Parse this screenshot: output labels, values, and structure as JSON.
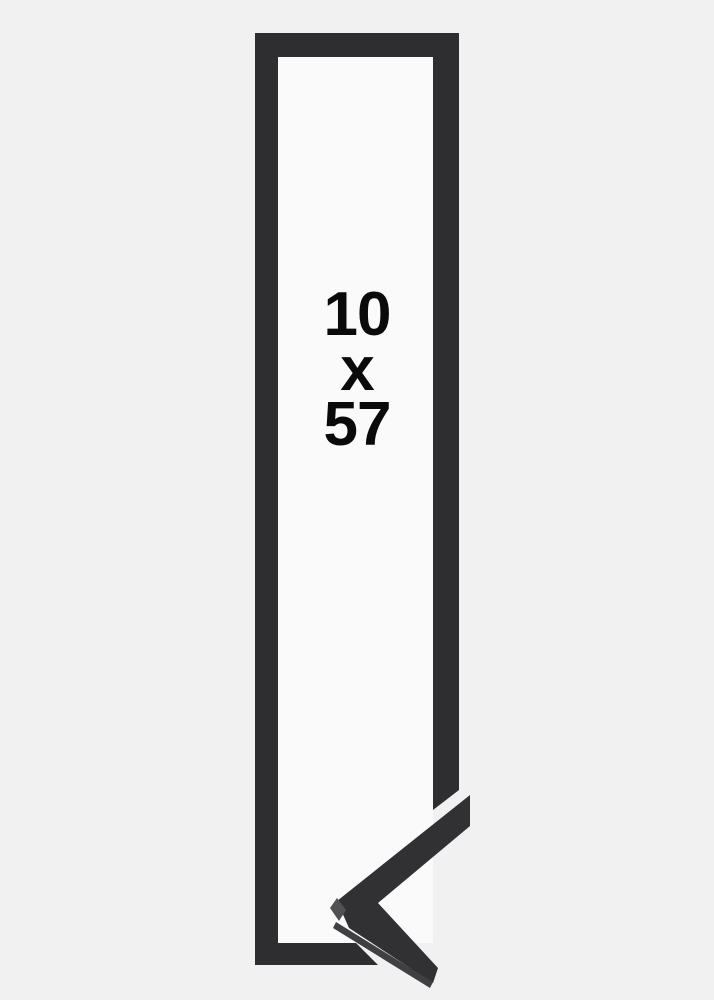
{
  "size_label": {
    "width": "10",
    "separator": "x",
    "height": "57"
  },
  "colors": {
    "background": "#f1f1f2",
    "inner": "#fafafa",
    "frame": "#2e2e30",
    "sample": "#313134",
    "bevel_light": "#515154",
    "bevel_mid": "#404043",
    "text": "#0a0a0a"
  }
}
